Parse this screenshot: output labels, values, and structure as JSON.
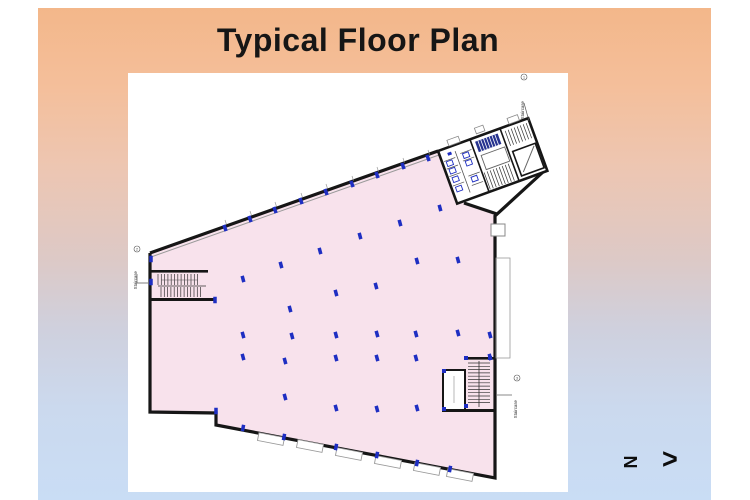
{
  "slide": {
    "title": "Typical Floor Plan"
  },
  "north_indicator": {
    "letter": "N",
    "arrow": ">"
  },
  "labels": {
    "staircase1": {
      "label": "Staircase",
      "number": "1"
    },
    "staircase2": {
      "label": "Staircase",
      "number": "2"
    },
    "staircase3": {
      "label": "Staircase",
      "number": "3"
    }
  },
  "colors": {
    "floor_fill": "#f8e2ec",
    "wall": "#161616",
    "column": "#1e2ec2",
    "stair_block": "#26338f",
    "slide_top": "#f3b78a",
    "slide_bottom": "#c9ddf5",
    "annotation": "#999999"
  },
  "plan": {
    "column_groups": [
      {
        "angle": -15,
        "points": [
          [
            312,
            135
          ],
          [
            272,
            150
          ],
          [
            232,
            163
          ],
          [
            192,
            178
          ],
          [
            153,
            192
          ],
          [
            115,
            206
          ],
          [
            289,
            188
          ],
          [
            330,
            187
          ],
          [
            248,
            213
          ],
          [
            208,
            220
          ],
          [
            162,
            236
          ],
          [
            115,
            262
          ],
          [
            164,
            263
          ],
          [
            208,
            262
          ],
          [
            249,
            261
          ],
          [
            288,
            261
          ],
          [
            330,
            260
          ],
          [
            362,
            262
          ],
          [
            115,
            284
          ],
          [
            157,
            288
          ],
          [
            208,
            285
          ],
          [
            249,
            285
          ],
          [
            288,
            285
          ],
          [
            362,
            284
          ],
          [
            157,
            324
          ],
          [
            208,
            335
          ],
          [
            249,
            336
          ],
          [
            289,
            335
          ]
        ]
      },
      {
        "angle": -20,
        "points": [
          [
            97,
            155
          ],
          [
            122,
            146
          ],
          [
            147,
            137
          ],
          [
            173,
            128
          ],
          [
            198,
            119
          ],
          [
            224,
            111
          ],
          [
            249,
            102
          ],
          [
            275,
            93
          ],
          [
            300,
            85
          ]
        ]
      },
      {
        "angle": 11,
        "points": [
          [
            115,
            355
          ],
          [
            156,
            364
          ],
          [
            208,
            374
          ],
          [
            249,
            382
          ],
          [
            289,
            390
          ],
          [
            322,
            396
          ]
        ]
      },
      {
        "angle": 0,
        "points": [
          [
            23,
            186
          ],
          [
            23,
            209
          ],
          [
            87,
            227
          ],
          [
            88,
            338
          ]
        ]
      }
    ],
    "windows": [
      [
        143,
        366
      ],
      [
        182,
        373
      ],
      [
        221,
        381
      ],
      [
        260,
        389
      ],
      [
        299,
        396
      ],
      [
        332,
        402
      ]
    ],
    "ticks": [
      [
        97,
        147
      ],
      [
        122,
        138
      ],
      [
        147,
        129
      ],
      [
        173,
        120
      ],
      [
        198,
        111
      ],
      [
        224,
        103
      ],
      [
        249,
        94
      ],
      [
        275,
        85
      ],
      [
        300,
        77
      ]
    ]
  }
}
